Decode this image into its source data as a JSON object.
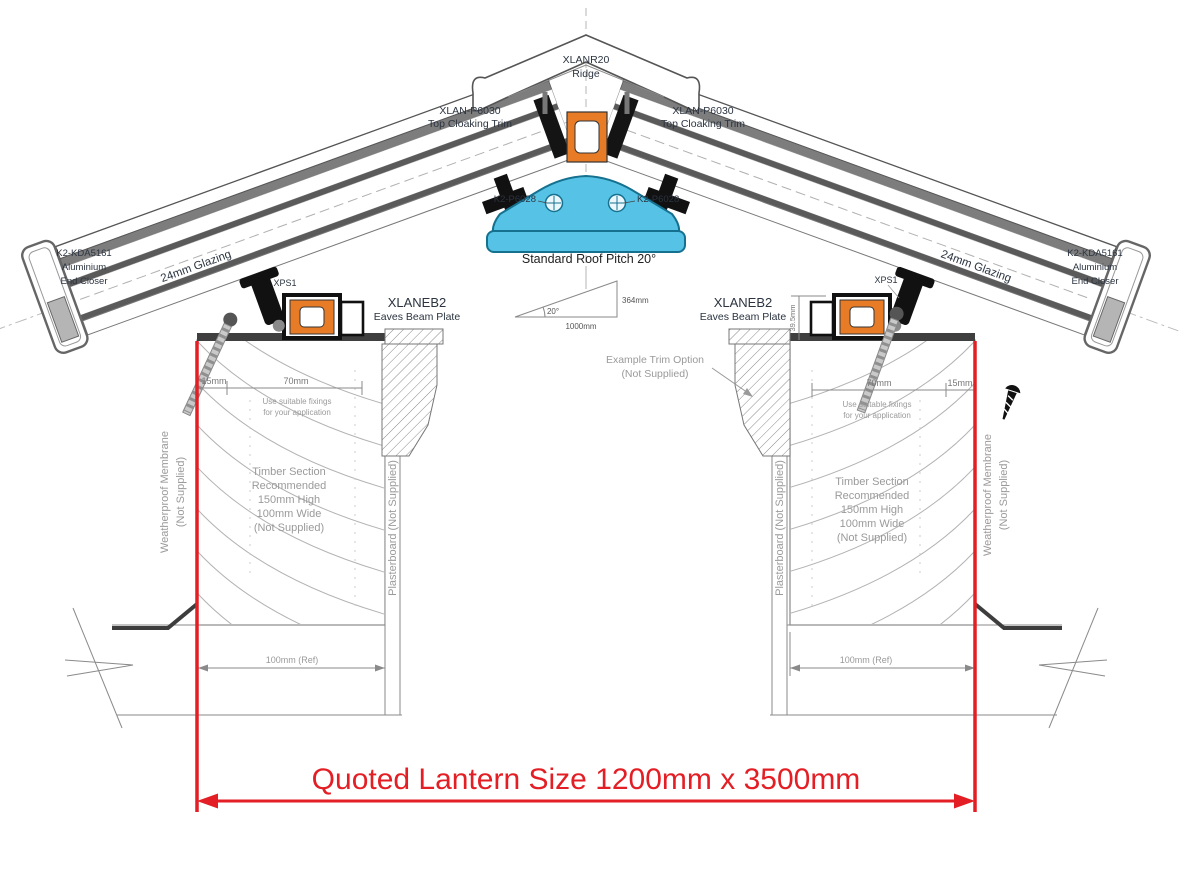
{
  "labels": {
    "ridge": {
      "code": "XLANR20",
      "name": "Ridge"
    },
    "top_cloaking_trim": {
      "code": "XLAN-P6030",
      "name": "Top Cloaking Trim"
    },
    "ridge_fixing": "K2-P6028",
    "pitch_title": "Standard Roof Pitch 20°",
    "pitch_angle": "20°",
    "pitch_base": "1000mm",
    "pitch_rise": "364mm",
    "glazing": "24mm Glazing",
    "end_closer": {
      "l1": "K2-KDA5161",
      "l2": "Aluminium",
      "l3": "End Closer"
    },
    "eaves_beam": {
      "code": "XLANEB2",
      "name": "Eaves Beam Plate"
    },
    "xps": "XPS1",
    "beam_height_dim": "39.5mm",
    "dim_15": "15mm",
    "dim_70": "70mm",
    "fixings_note": {
      "l1": "Use suitable fixings",
      "l2": "for your application"
    },
    "timber_note": {
      "l1": "Timber Section",
      "l2": "Recommended",
      "l3": "150mm High",
      "l4": "100mm Wide",
      "l5": "(Not Supplied)"
    },
    "membrane": {
      "l1": "Weatherproof Membrane",
      "l2": "(Not Supplied)"
    },
    "plasterboard": "Plasterboard (Not Supplied)",
    "trim_option": {
      "l1": "Example Trim Option",
      "l2": "(Not Supplied)"
    },
    "ref_dim": "100mm (Ref)",
    "quoted_size": "Quoted Lantern Size 1200mm x 3500mm"
  },
  "colors": {
    "accent_red": "#e31e24",
    "profile_blue": "#56c3e6",
    "thermal_break_orange": "#e87c26",
    "hatch_grey": "#8a8a8a"
  }
}
